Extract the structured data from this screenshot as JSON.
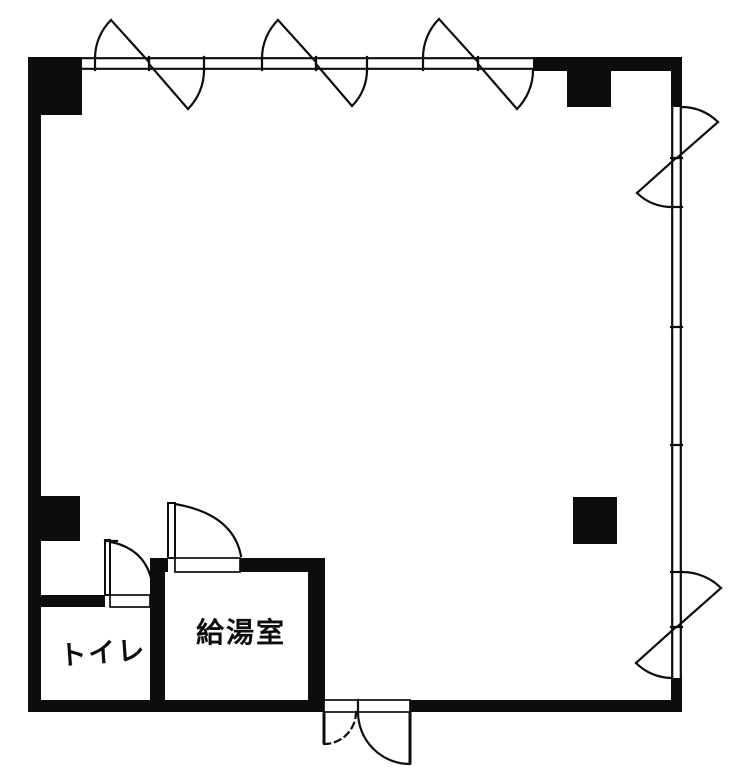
{
  "canvas": {
    "background": "#ffffff",
    "ink": "#0d0d0d",
    "type": "floor-plan"
  },
  "rooms": {
    "toilet": {
      "label": "トイレ"
    },
    "kitchenette": {
      "label": "給湯室"
    }
  },
  "fixtures": {
    "casement_window_pairs_top_wall": 3,
    "casement_window_pairs_right_wall": 2,
    "structural_columns": 4,
    "swing_doors": [
      "toilet-door",
      "kitchenette-door"
    ],
    "entrance": "double-leaf-outswing-door"
  }
}
